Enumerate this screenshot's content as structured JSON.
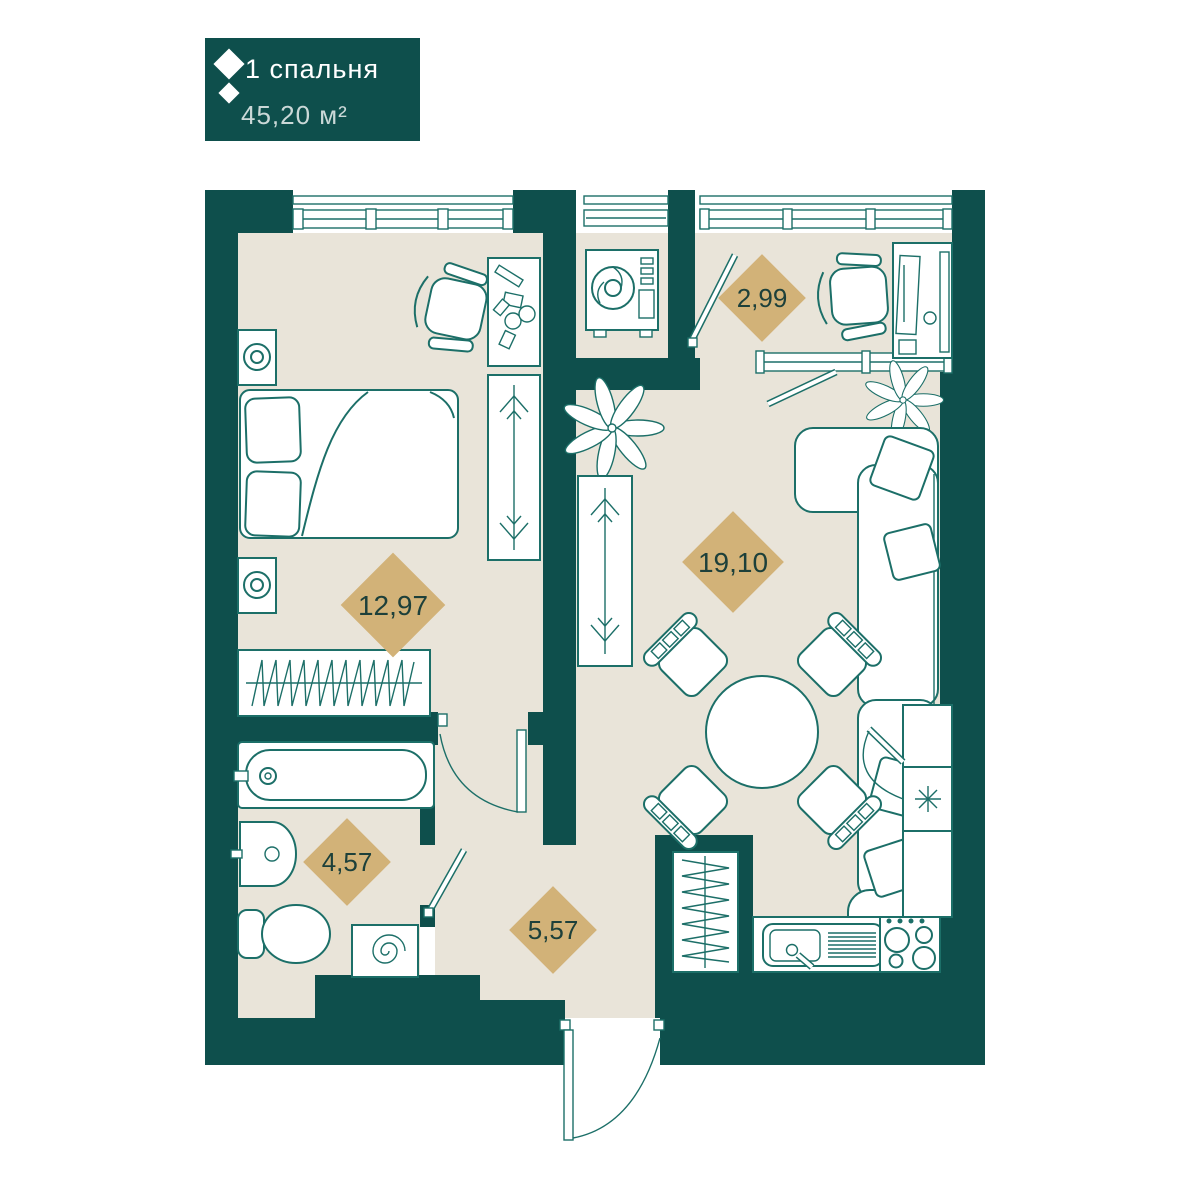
{
  "badge": {
    "title": "1 спальня",
    "area": "45,20 м²",
    "icon": "diamond-logo-icon",
    "bg_color": "#0e4f4c",
    "text_color": "#ffffff"
  },
  "rooms": {
    "bedroom": {
      "name": "bedroom",
      "area": "12,97"
    },
    "living": {
      "name": "living-kitchen",
      "area": "19,10"
    },
    "balcony": {
      "name": "balcony",
      "area": "2,99"
    },
    "bathroom": {
      "name": "bathroom",
      "area": "4,57"
    },
    "hallway": {
      "name": "hallway",
      "area": "5,57"
    }
  },
  "colors": {
    "wall": "#0e4f4c",
    "floor": "#e9e4d9",
    "furniture_line": "#1c6f68",
    "area_diamond": "#d2b278",
    "area_text": "#1d403a"
  },
  "furniture_icons": {
    "bedroom": [
      "double-bed",
      "pillow",
      "pillow",
      "nightstand-lamp",
      "nightstand-lamp",
      "desk-chair",
      "dressing-table",
      "wardrobe-hangers",
      "radiator",
      "window"
    ],
    "balcony": [
      "office-chair",
      "desk-monitor",
      "glazing",
      "balcony-door"
    ],
    "ac_alcove": [
      "air-conditioner-unit",
      "window"
    ],
    "living": [
      "corner-sofa",
      "throw-pillows",
      "plant",
      "plant",
      "wardrobe-hangers",
      "round-dining-table",
      "dining-chair-x4",
      "radiator"
    ],
    "kitchen": [
      "sink-with-drainer",
      "stove-4-burners",
      "fridge-snowflake",
      "tall-cabinets"
    ],
    "bathroom": [
      "bathtub",
      "wash-basin",
      "toilet",
      "washing-machine-spiral",
      "door"
    ],
    "hallway": [
      "entrance-door-arc"
    ]
  }
}
